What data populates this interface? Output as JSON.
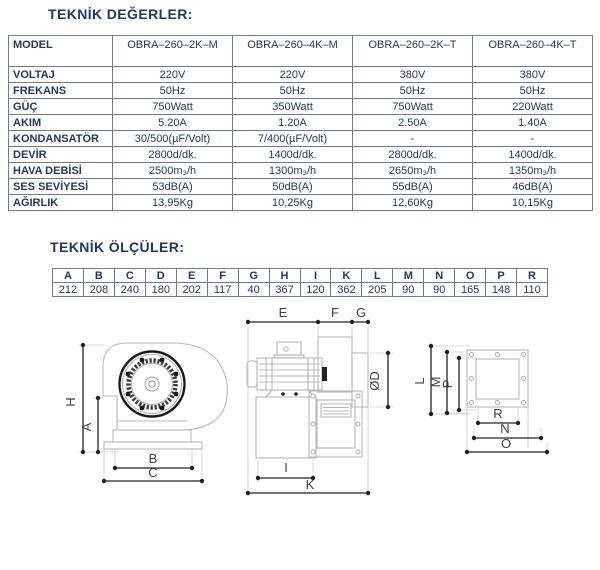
{
  "titles": {
    "values": "TEKNİK DEĞERLER:",
    "dimensions": "TEKNİK ÖLÇÜLER:"
  },
  "spec_table": {
    "header": [
      "MODEL",
      "OBRA–260–2K–M",
      "OBRA–260–4K–M",
      "OBRA–260–2K–T",
      "OBRA–260–4K–T"
    ],
    "rows": [
      {
        "label": "VOLTAJ",
        "values": [
          "220V",
          "220V",
          "380V",
          "380V"
        ]
      },
      {
        "label": "FREKANS",
        "values": [
          "50Hz",
          "50Hz",
          "50Hz",
          "50Hz"
        ]
      },
      {
        "label": "GÜÇ",
        "values": [
          "750Watt",
          "350Watt",
          "750Watt",
          "220Watt"
        ]
      },
      {
        "label": "AKIM",
        "values": [
          "5.20A",
          "1.20A",
          "2.50A",
          "1.40A"
        ]
      },
      {
        "label": "KONDANSATÖR",
        "values": [
          "30/500(µF/Volt)",
          "7/400(µF/Volt)",
          "-",
          "-"
        ]
      },
      {
        "label": "DEVİR",
        "values": [
          "2800d/dk.",
          "1400d/dk.",
          "2800d/dk.",
          "1400d/dk."
        ]
      },
      {
        "label": "HAVA DEBİSİ",
        "values": [
          "2500m₃/h",
          "1300m₃/h",
          "2650m₃/h",
          "1350m₃/h"
        ]
      },
      {
        "label": "SES SEVİYESİ",
        "values": [
          "53dB(A)",
          "50dB(A)",
          "55dB(A)",
          "46dB(A)"
        ]
      },
      {
        "label": "AĞIRLIK",
        "values": [
          "13,95Kg",
          "10,25Kg",
          "12,60Kg",
          "10,15Kg"
        ]
      }
    ]
  },
  "dim_table": {
    "letters": [
      "A",
      "B",
      "C",
      "D",
      "E",
      "F",
      "G",
      "H",
      "I",
      "K",
      "L",
      "M",
      "N",
      "O",
      "P",
      "R"
    ],
    "values": [
      "212",
      "208",
      "240",
      "180",
      "202",
      "117",
      "40",
      "367",
      "120",
      "362",
      "205",
      "90",
      "90",
      "165",
      "148",
      "110"
    ]
  },
  "drawings": {
    "side": {
      "h": "H",
      "a": "A",
      "b": "B",
      "c": "C"
    },
    "front": {
      "e": "E",
      "f": "F",
      "g": "G",
      "d": "ØD",
      "i": "I",
      "k": "K"
    },
    "flange": {
      "l": "L",
      "m": "M",
      "p": "P",
      "r": "R",
      "n": "N",
      "o": "O"
    }
  },
  "colors": {
    "text_navy": "#26365f",
    "table_border": "#707a8c",
    "dim_line": "#222222",
    "drawing_line": "#b9b9b9"
  }
}
